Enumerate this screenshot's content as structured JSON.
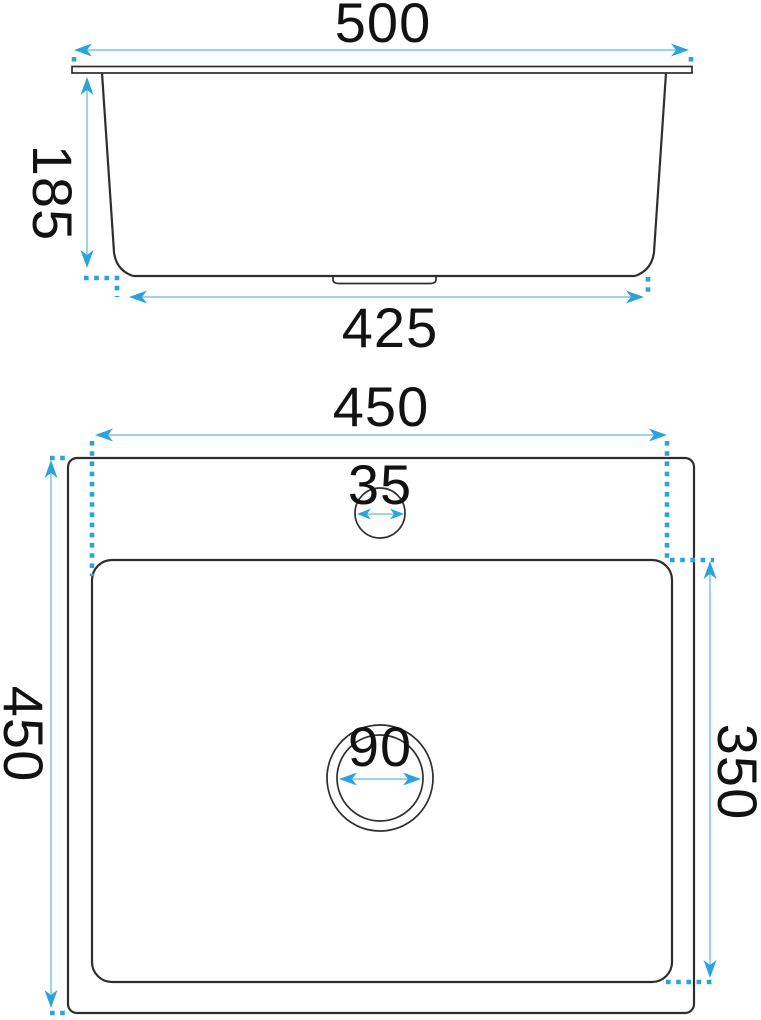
{
  "colors": {
    "dimension_accent": "#2aa3da",
    "dimension_line": "#7fc3e6",
    "outline": "#2e2e2e",
    "label_text": "#121212",
    "background": "#ffffff"
  },
  "side_view": {
    "top_width": "500",
    "depth": "185",
    "bottom_width": "425"
  },
  "plan_view": {
    "bowl_width": "450",
    "faucet_hole_diameter": "35",
    "outer_height": "450",
    "bowl_length": "350",
    "drain_diameter": "90"
  }
}
